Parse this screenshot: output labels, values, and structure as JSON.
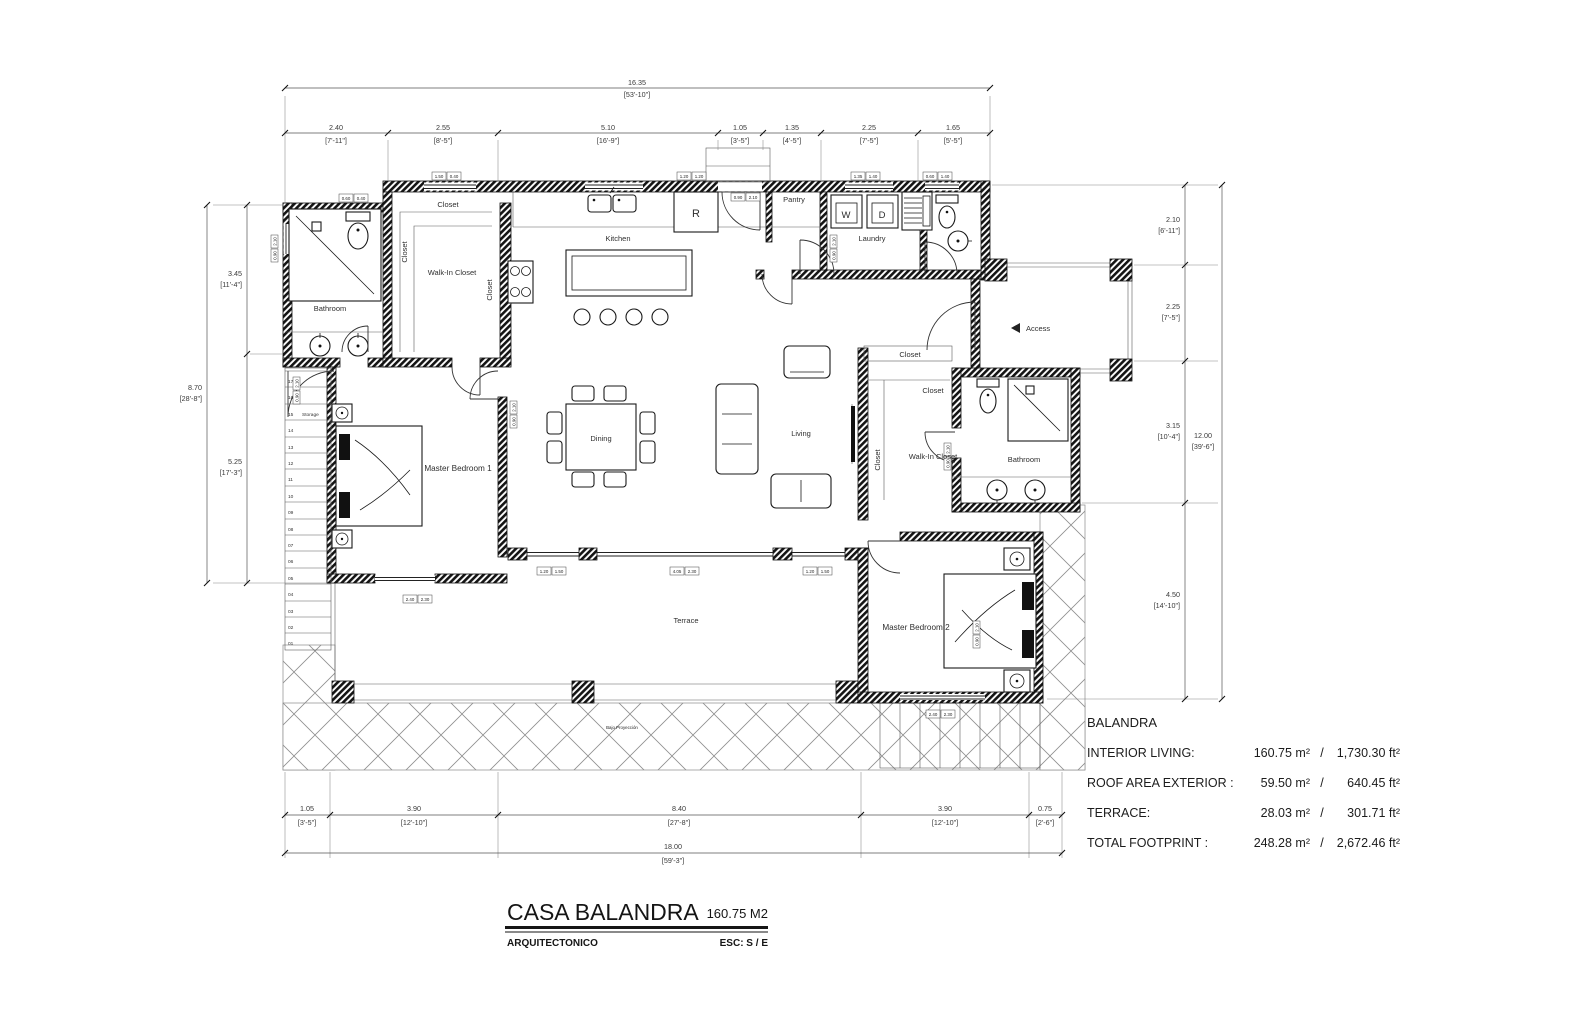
{
  "drawing": {
    "rooms": {
      "bathroom1": "Bathroom",
      "closet_top": "Closet",
      "closet_left": "Closet",
      "walkin1": "Walk-In Closet",
      "closet_mid": "Closet",
      "kitchen": "Kitchen",
      "pantry": "Pantry",
      "laundry": "Laundry",
      "master1": "Master Bedroom 1",
      "dining": "Dining",
      "living": "Living",
      "access": "Access",
      "closet_a": "Closet",
      "closet_b": "Closet",
      "closet_c": "Closet",
      "walkin2": "Walk-In Closet",
      "bathroom2": "Bathroom",
      "master2": "Master Bedroom 2",
      "terrace": "Terrace",
      "under_projection": "Bajo Proyección"
    },
    "fixtures": {
      "fridge": "R",
      "washer": "W",
      "dryer": "D"
    },
    "stairs": {
      "storage": "Storage",
      "numbers": [
        "17",
        "16",
        "15",
        "14",
        "13",
        "12",
        "11",
        "10",
        "09",
        "08",
        "07",
        "06",
        "05",
        "04",
        "03",
        "02",
        "01"
      ]
    }
  },
  "dims": {
    "top_overall": {
      "m": "16.35",
      "ft": "[53'-10\"]"
    },
    "top": [
      {
        "m": "2.40",
        "ft": "[7'-11\"]"
      },
      {
        "m": "2.55",
        "ft": "[8'-5\"]"
      },
      {
        "m": "5.10",
        "ft": "[16'-9\"]"
      },
      {
        "m": "1.05",
        "ft": "[3'-5\"]"
      },
      {
        "m": "1.35",
        "ft": "[4'-5\"]"
      },
      {
        "m": "2.25",
        "ft": "[7'-5\"]"
      },
      {
        "m": "1.65",
        "ft": "[5'-5\"]"
      }
    ],
    "left_overall": {
      "m": "8.70",
      "ft": "[28'-8\"]"
    },
    "left": [
      {
        "m": "3.45",
        "ft": "[11'-4\"]"
      },
      {
        "m": "5.25",
        "ft": "[17'-3\"]"
      }
    ],
    "right_overall": {
      "m": "12.00",
      "ft": "[39'-6\"]"
    },
    "right": [
      {
        "m": "2.10",
        "ft": "[6'-11\"]"
      },
      {
        "m": "2.25",
        "ft": "[7'-5\"]"
      },
      {
        "m": "3.15",
        "ft": "[10'-4\"]"
      },
      {
        "m": "4.50",
        "ft": "[14'-10\"]"
      }
    ],
    "bottom_overall": {
      "m": "18.00",
      "ft": "[59'-3\"]"
    },
    "bottom": [
      {
        "m": "1.05",
        "ft": "[3'-5\"]"
      },
      {
        "m": "3.90",
        "ft": "[12'-10\"]"
      },
      {
        "m": "8.40",
        "ft": "[27'-8\"]"
      },
      {
        "m": "3.90",
        "ft": "[12'-10\"]"
      },
      {
        "m": "0.75",
        "ft": "[2'-6\"]"
      }
    ]
  },
  "window_tags": [
    {
      "a": "0.60",
      "b": "0.40"
    },
    {
      "a": "1.50",
      "b": "0.40"
    },
    {
      "a": "1.20",
      "b": "1.20"
    },
    {
      "a": "0.90",
      "b": "2.10"
    },
    {
      "a": "1.35",
      "b": "1.40"
    },
    {
      "a": "0.60",
      "b": "1.40"
    },
    {
      "a": "1.20",
      "b": "1.50"
    },
    {
      "a": "4.05",
      "b": "2.30"
    },
    {
      "a": "1.20",
      "b": "1.50"
    },
    {
      "a": "2.40",
      "b": "2.30"
    },
    {
      "a": "2.40",
      "b": "2.30"
    }
  ],
  "door_tag": {
    "a": "0.90",
    "b": "2.10"
  },
  "summary": {
    "heading": "BALANDRA",
    "sep": "/",
    "rows": [
      {
        "label": "INTERIOR LIVING:",
        "m2": "160.75 m²",
        "ft2": "1,730.30 ft²"
      },
      {
        "label": "ROOF AREA EXTERIOR :",
        "m2": "59.50 m²",
        "ft2": "640.45 ft²"
      },
      {
        "label": "TERRACE:",
        "m2": "28.03 m²",
        "ft2": "301.71 ft²"
      },
      {
        "label": "TOTAL FOOTPRINT :",
        "m2": "248.28 m²",
        "ft2": "2,672.46 ft²"
      }
    ]
  },
  "title_block": {
    "project": "CASA BALANDRA",
    "area": "160.75 M2",
    "sheet": "ARQUITECTONICO",
    "scale": "ESC: S / E"
  }
}
